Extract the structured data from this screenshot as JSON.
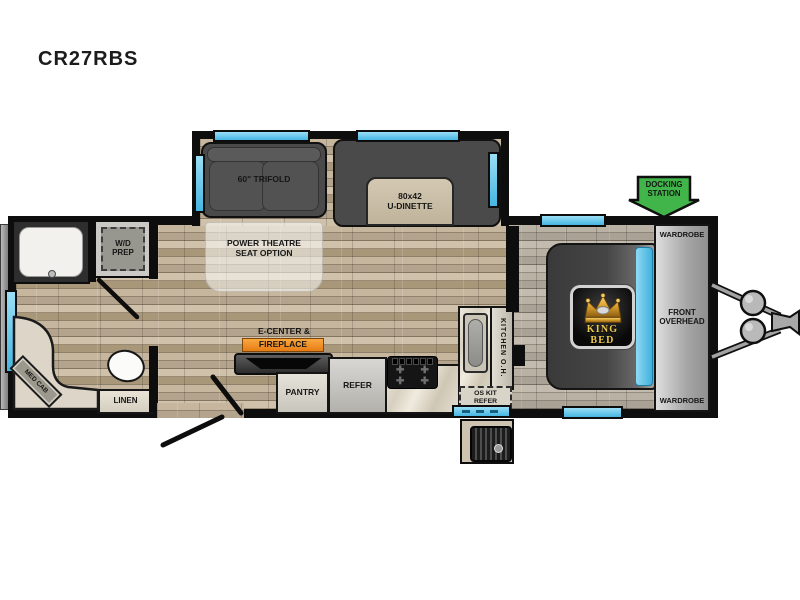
{
  "title": "CR27RBS",
  "slideout": {
    "trifold_label": "60\" TRIFOLD",
    "dinette_size": "80x42",
    "dinette_name": "U-DINETTE"
  },
  "living": {
    "power_theatre_line1": "POWER THEATRE",
    "power_theatre_line2": "SEAT OPTION",
    "ecenter_label": "E-CENTER &",
    "fireplace_label": "FIREPLACE",
    "pantry_label": "PANTRY",
    "refer_label": "REFER"
  },
  "bath": {
    "wd_prep_line1": "W/D",
    "wd_prep_line2": "PREP",
    "med_cab_label": "MED CAB",
    "linen_label": "LINEN"
  },
  "kitchen": {
    "overhead_label": "KITCHEN O.H.",
    "os_refer_line1": "OS KIT",
    "os_refer_line2": "REFER"
  },
  "bedroom": {
    "bed_label": "KING BED",
    "wardrobe_top_label": "WARDROBE",
    "wardrobe_bottom_label": "WARDROBE",
    "overhead_line1": "FRONT",
    "overhead_line2": "OVERHEAD"
  },
  "exterior": {
    "docking_line1": "DOCKING",
    "docking_line2": "STATION"
  },
  "colors": {
    "window_blue": "#5ec7ec",
    "fireplace_orange": "#f08a1d",
    "docking_green": "#41b54a",
    "crown_gold": "#e7b94c"
  }
}
